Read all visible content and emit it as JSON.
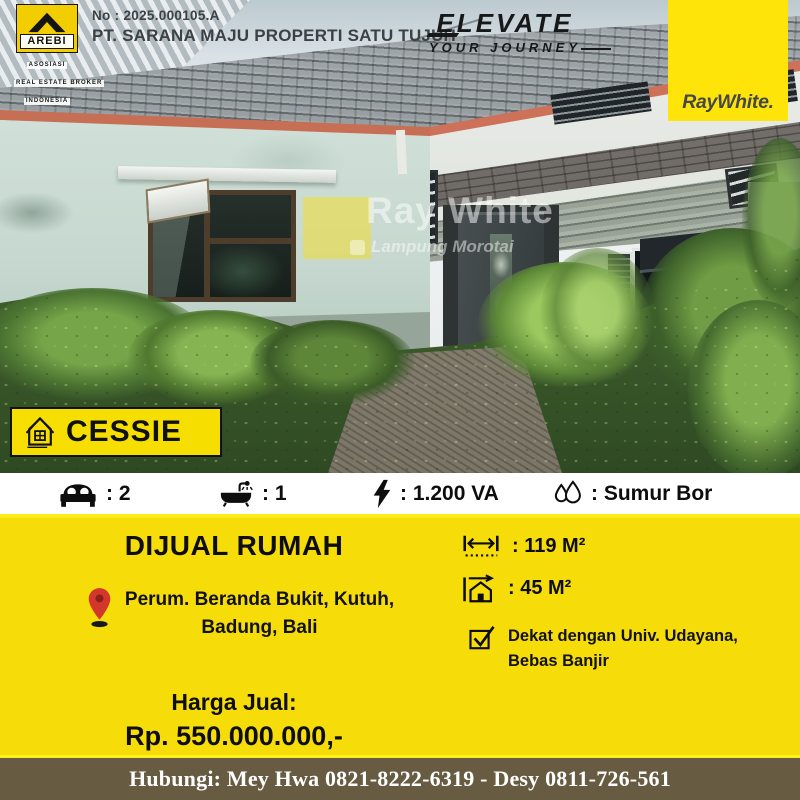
{
  "header": {
    "listing_no": "No : 2025.000105.A",
    "company": "PT. SARANA MAJU PROPERTI SATU TUJUH",
    "arebi": {
      "name": "AREBI",
      "sub1": "ASOSIASI",
      "sub2": "REAL ESTATE BROKER",
      "sub3": "INDONESIA"
    },
    "elevate": {
      "line1": "ELEVATE",
      "line2": "YOUR JOURNEY"
    },
    "brand": "RayWhite."
  },
  "photo": {
    "watermark_title": "Ray White",
    "watermark_sub": "Lampung Morotai",
    "badge": "CESSIE"
  },
  "features": [
    {
      "icon": "bed-icon",
      "value": ": 2"
    },
    {
      "icon": "bath-icon",
      "value": ": 1"
    },
    {
      "icon": "electricity-icon",
      "value": ": 1.200 VA"
    },
    {
      "icon": "water-icon",
      "value": ": Sumur Bor"
    }
  ],
  "details": {
    "title": "DIJUAL RUMAH",
    "location_line1": "Perum. Beranda Bukit, Kutuh,",
    "location_line2": "Badung, Bali",
    "price_label": "Harga Jual:",
    "price": "Rp. 550.000.000,-",
    "land_area": ": 119 M²",
    "building_area": ": 45 M²",
    "note_line1": "Dekat dengan Univ. Udayana,",
    "note_line2": "Bebas Banjir"
  },
  "footer": {
    "contact": "Hubungi: Mey Hwa 0821-8222-6319 - Desy 0811-726-561"
  },
  "colors": {
    "section_yellow": "#F6DD0A",
    "raywhite_yellow": "#FFE40A",
    "badge_yellow": "#F6DF00",
    "footer_bg": "#675C42",
    "pin_red": "#D3372B"
  }
}
